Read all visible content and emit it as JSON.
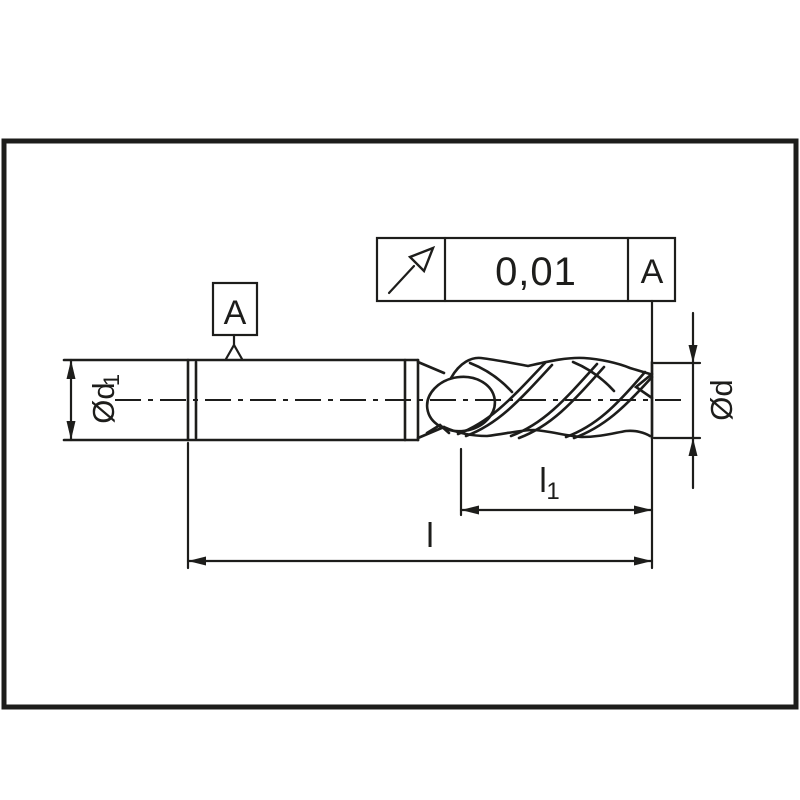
{
  "page": {
    "background": "#ffffff",
    "line_color": "#1d1d1b"
  },
  "tolerance_frame": {
    "icon": "circular-runout",
    "value": "0,01",
    "datum": "A"
  },
  "datum_feature": {
    "label": "A"
  },
  "dims": {
    "shank_dia_main": "Ød",
    "shank_dia_sub": "1",
    "cut_dia": "Ød",
    "flute_len_main": "l",
    "flute_len_sub": "1",
    "overall_len": "l"
  }
}
